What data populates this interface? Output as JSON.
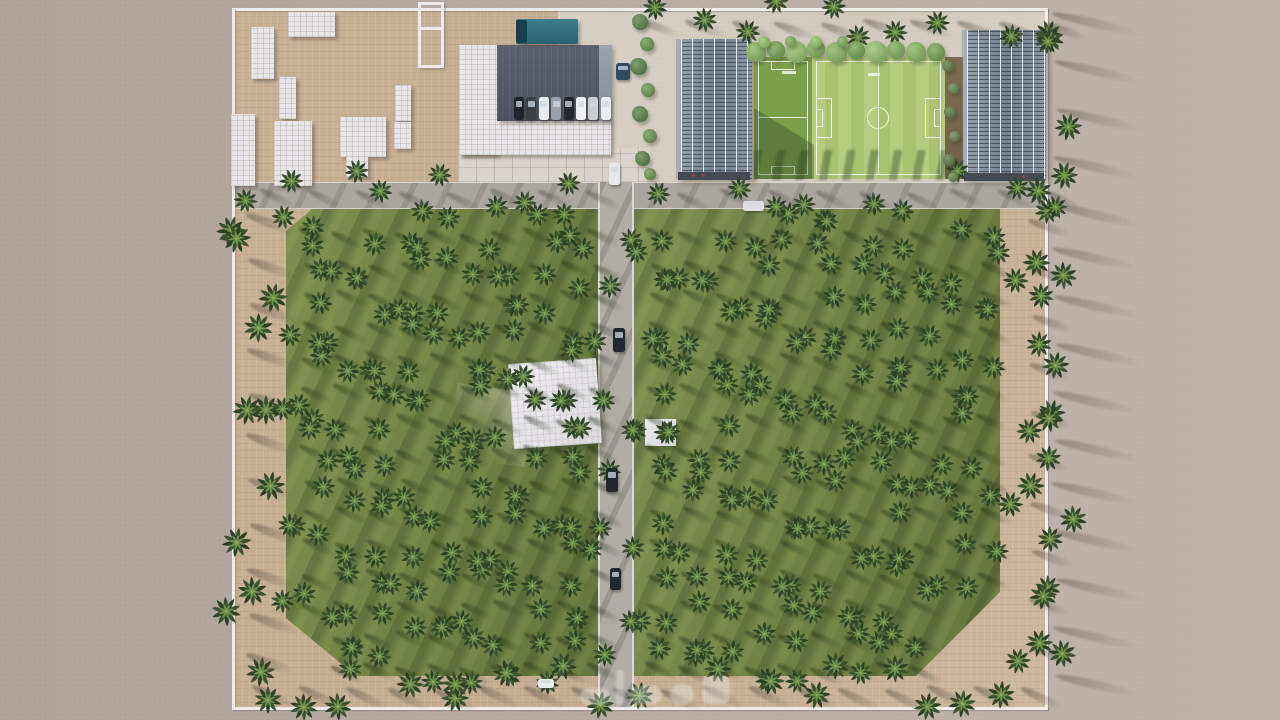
{
  "scene": {
    "description": "Top-down 3D architectural rendering of a walled palm-tree farm estate in a desert; two large palm orchards split by a central road, with a facility zone (warehouse, housing blocks, two solar-roof greenhouses and a football field) along the top edge",
    "watermark": {
      "present": true,
      "script": "arabic",
      "legible": false,
      "label": "faint white logo watermark"
    }
  },
  "palette": {
    "sand": "#b4a9a1",
    "sand_light": "#beb3ab",
    "paver_tan": "#c6ae92",
    "pavement_light": "#d6cdc2",
    "road": "#aba69f",
    "road_curb": "#dcd8d2",
    "wall_white": "#efede9",
    "grass_base": "#728346",
    "grass_streak_dark": "#4c5f35",
    "grass_streak_light": "#a0ac5f",
    "field_dark_green": "#7aa04c",
    "field_stripe_a": "#b6cd80",
    "field_stripe_b": "#a9c271",
    "palm_frond_dark": "#2c4126",
    "palm_frond_light": "#6f924c",
    "roof_dark_gray": "#545c68",
    "building_white": "#e8e6e8",
    "solar_panel_gray": "#76828e",
    "truck_teal": "#2e6d7d",
    "round_tree_green": "#71a34c"
  },
  "vegetation": {
    "palm_grids": [
      {
        "id": "orchard-left",
        "x": 302,
        "y": 230,
        "cols": 10,
        "rows": 15,
        "dx": 32,
        "dy": 31,
        "size": 27,
        "shadow": "grass",
        "skip_zone": {
          "x1": 280,
          "y1": 612,
          "x2": 318,
          "y2": 690
        }
      },
      {
        "id": "orchard-right",
        "x": 648,
        "y": 230,
        "cols": 11,
        "rows": 15,
        "dx": 33,
        "dy": 31,
        "size": 27,
        "shadow": "grass",
        "skip_zone": {
          "x1": 935,
          "y1": 600,
          "x2": 1010,
          "y2": 690
        }
      }
    ],
    "palm_lines": [
      {
        "id": "west-perimeter",
        "x": 248,
        "y": 215,
        "dx": 0,
        "dy": 44,
        "count": 11,
        "size": 33,
        "shadow": "sand"
      },
      {
        "id": "bottom-row",
        "x": 254,
        "y": 686,
        "dx": 45,
        "dy": 0,
        "count": 18,
        "size": 31,
        "shadow": "road"
      },
      {
        "id": "right-inner",
        "x": 1030,
        "y": 220,
        "dx": 0,
        "dy": 47,
        "count": 10,
        "size": 29,
        "shadow": "sand"
      },
      {
        "id": "east-outer",
        "x": 1054,
        "y": 14,
        "dx": 0,
        "dy": 47,
        "count": 15,
        "size": 31,
        "shadow": "sand-long"
      },
      {
        "id": "top-row",
        "x": 640,
        "y": 20,
        "dx": 45,
        "dy": 0,
        "count": 10,
        "size": 28,
        "shadow": "sand"
      },
      {
        "id": "midroad-row",
        "x": 262,
        "y": 190,
        "dx": 46,
        "dy": 0,
        "count": 18,
        "size": 27,
        "shadow": "road",
        "skip_zone": {
          "x1": 594,
          "y1": 170,
          "x2": 636,
          "y2": 212
        }
      }
    ],
    "round_trees": [
      [
        756,
        52,
        20,
        "#7fae54"
      ],
      [
        776,
        50,
        18,
        "#6b9c47"
      ],
      [
        796,
        52,
        22,
        "#8cba60"
      ],
      [
        816,
        49,
        18,
        "#74a64e"
      ],
      [
        836,
        52,
        21,
        "#7fae54"
      ],
      [
        856,
        50,
        18,
        "#6b9c47"
      ],
      [
        876,
        52,
        22,
        "#8cba60"
      ],
      [
        896,
        50,
        18,
        "#74a64e"
      ],
      [
        916,
        52,
        20,
        "#7fae54"
      ],
      [
        936,
        52,
        18,
        "#6b9c47"
      ],
      [
        764,
        42,
        12,
        "#8cba60"
      ],
      [
        790,
        41,
        11,
        "#74a64e"
      ],
      [
        816,
        42,
        12,
        "#8cba60"
      ],
      [
        842,
        41,
        11,
        "#74a64e"
      ],
      [
        640,
        22,
        16,
        "#4e7a3c"
      ],
      [
        647,
        44,
        14,
        "#5f8c44"
      ],
      [
        638,
        66,
        17,
        "#4e7a3c"
      ],
      [
        648,
        90,
        14,
        "#5f8c44"
      ],
      [
        640,
        114,
        16,
        "#4e7a3c"
      ],
      [
        650,
        136,
        14,
        "#5f8c44"
      ],
      [
        642,
        158,
        15,
        "#4e7a3c"
      ],
      [
        650,
        174,
        12,
        "#5f8c44"
      ],
      [
        948,
        66,
        12,
        "#55703a"
      ],
      [
        953,
        88,
        11,
        "#5f7c40"
      ],
      [
        950,
        112,
        12,
        "#55703a"
      ],
      [
        954,
        136,
        11,
        "#5f7c40"
      ],
      [
        949,
        160,
        12,
        "#55703a"
      ],
      [
        953,
        177,
        10,
        "#5f7c40"
      ]
    ]
  },
  "buildings": {
    "white_blocks": [
      [
        288,
        12,
        47,
        25
      ],
      [
        251,
        27,
        23,
        52
      ],
      [
        279,
        77,
        17,
        42
      ],
      [
        231,
        114,
        24,
        72
      ],
      [
        274,
        121,
        38,
        65
      ],
      [
        340,
        117,
        46,
        40
      ],
      [
        346,
        157,
        22,
        20
      ],
      [
        395,
        85,
        16,
        36
      ],
      [
        394,
        122,
        17,
        27
      ]
    ]
  },
  "vehicles": {
    "truck": {
      "x": 516,
      "y": 19,
      "body": "#2e6d7d",
      "cab": "#17404c"
    },
    "parked_row": {
      "x": 514,
      "y": 97,
      "dx": 12.4,
      "count": 8,
      "w": 10,
      "h": 23,
      "colors": [
        "#22262b",
        "#3a3f46",
        "#e9eaec",
        "#9aa0a6",
        "#23282e",
        "#f0f1f3",
        "#c9ccd0",
        "#eceded"
      ]
    },
    "cars": [
      {
        "x": 609,
        "y": 163,
        "w": 11,
        "h": 22,
        "c": "#e8e8ea"
      },
      {
        "x": 743,
        "y": 201,
        "w": 21,
        "h": 10,
        "c": "#dfdfe2"
      },
      {
        "x": 616,
        "y": 63,
        "w": 14,
        "h": 17,
        "c": "#35495c"
      },
      {
        "x": 613,
        "y": 328,
        "w": 12,
        "h": 24,
        "c": "#23282e"
      },
      {
        "x": 606,
        "y": 468,
        "w": 12,
        "h": 24,
        "c": "#23282e"
      },
      {
        "x": 610,
        "y": 568,
        "w": 11,
        "h": 22,
        "c": "#23282e"
      },
      {
        "x": 538,
        "y": 679,
        "w": 16,
        "h": 9,
        "c": "#e9eaec"
      }
    ]
  }
}
